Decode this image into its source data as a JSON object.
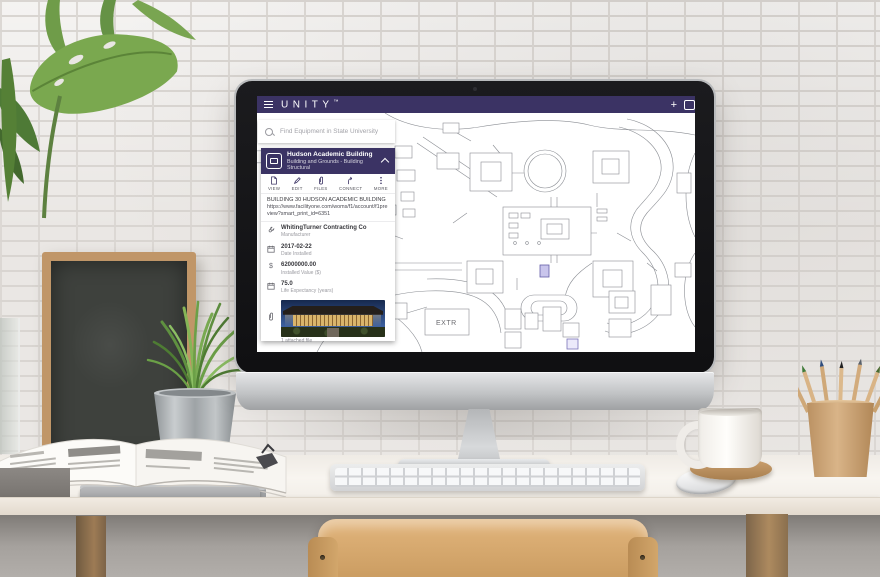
{
  "header": {
    "brand": "UNITY",
    "trademark": "™",
    "add_label": "+"
  },
  "search": {
    "placeholder": "Find Equipment in State University"
  },
  "panel": {
    "title": "Hudson Academic Building",
    "subtitle": "Building and Grounds - Building Structural",
    "toolbar": {
      "view": "VIEW",
      "edit": "EDIT",
      "files": "FILES",
      "connect": "CONNECT",
      "more": "MORE"
    },
    "description": "BUILDING 30 HUDSON ACADEMIC BUILDING",
    "link": "https://www.facilityone.com/woms/f1/account/f1preview?smart_print_id=6351",
    "fields": [
      {
        "value": "WhitingTurner Contracting Co",
        "label": "Manufacturer"
      },
      {
        "value": "2017-02-22",
        "label": "Date Installed"
      },
      {
        "value": "62000000.00",
        "label": "Installed Value ($)"
      },
      {
        "value": "75.0",
        "label": "Life Expectancy (years)"
      }
    ],
    "attachment_caption": "1 attached file"
  },
  "map": {
    "area_label": "EXTR",
    "line_color": "#8a8d93",
    "marker_fill": "#c9c5ec",
    "marker_stroke": "#655ea8"
  },
  "colors": {
    "brand_purple": "#3b3364",
    "panel_purple": "#3b3364"
  }
}
